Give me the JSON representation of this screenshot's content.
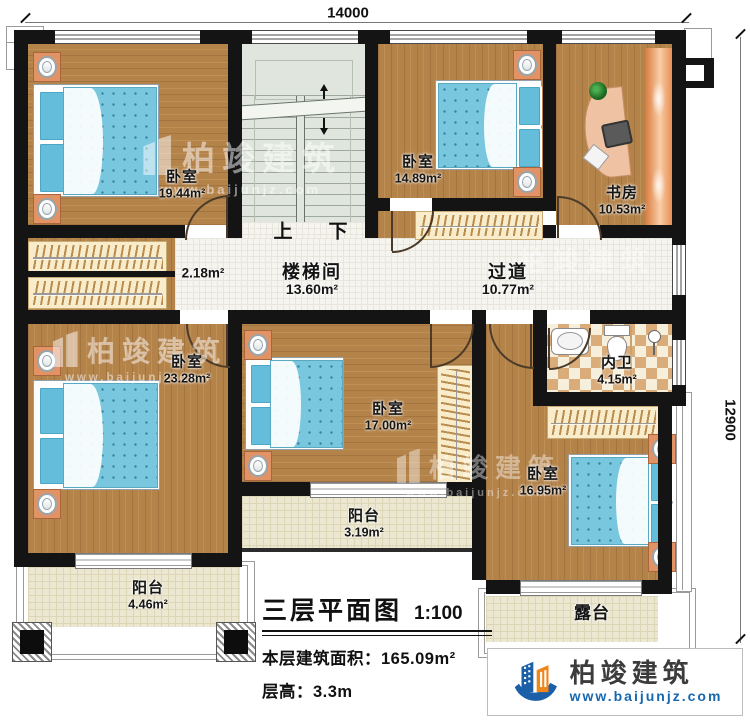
{
  "dimensions": {
    "top": "14000",
    "right": "12900"
  },
  "rooms": {
    "bedroom_tl": {
      "name": "卧室",
      "area": "19.44m²"
    },
    "bedroom_tr": {
      "name": "卧室",
      "area": "14.89m²"
    },
    "study": {
      "name": "书房",
      "area": "10.53m²"
    },
    "stairwell": {
      "name": "楼梯间",
      "area": "13.60m²"
    },
    "hall": {
      "area": "2.18m²"
    },
    "corridor": {
      "name": "过道",
      "area": "10.77m²"
    },
    "bathroom": {
      "name": "内卫",
      "area": "4.15m²"
    },
    "bedroom_left": {
      "name": "卧室",
      "area": "23.28m²"
    },
    "bedroom_center": {
      "name": "卧室",
      "area": "17.00m²"
    },
    "bedroom_right": {
      "name": "卧室",
      "area": "16.95m²"
    },
    "balcony_left": {
      "name": "阳台",
      "area": "4.46m²"
    },
    "balcony_center": {
      "name": "阳台",
      "area": "3.19m²"
    },
    "terrace": {
      "name": "露台"
    }
  },
  "stairs": {
    "up": "上",
    "down": "下"
  },
  "title_block": {
    "title": "三层平面图",
    "scale": "1:100",
    "area_label": "本层建筑面积：",
    "area_value": "165.09m²",
    "height_label": "层高：",
    "height_value": "3.3m"
  },
  "branding": {
    "company": "柏竣建筑",
    "website": "www.baijunjz.com"
  },
  "watermark": {
    "company": "柏竣建筑",
    "website": "www.baijunjz.com"
  },
  "colors": {
    "wall": "#141414",
    "wood": "#b4834a",
    "stair": "#e0e6dd",
    "tile": "#f5f4ef",
    "balcony": "#ece7d1",
    "bed_blue": "#79c7df",
    "nightstand": "#e29366",
    "logo_blue": "#1a5fa8",
    "logo_orange": "#f08519"
  }
}
